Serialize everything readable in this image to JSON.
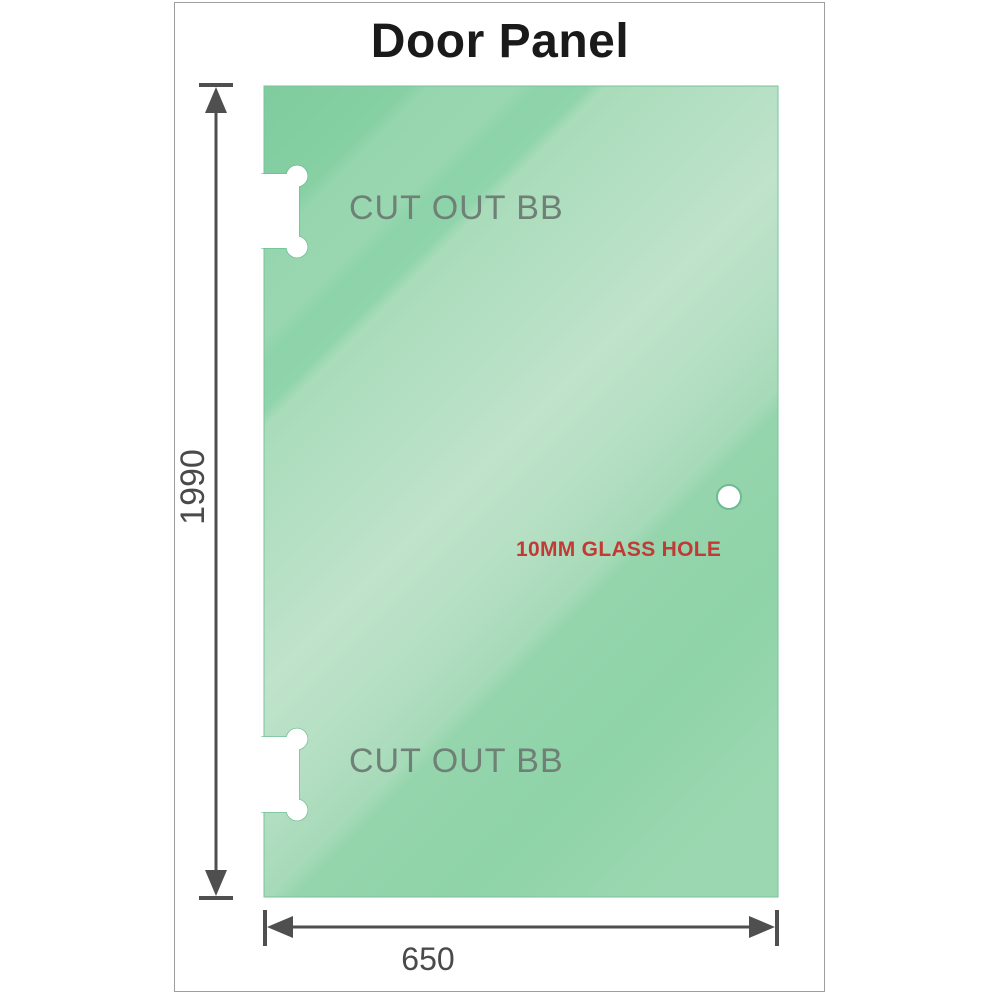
{
  "title": "Door Panel",
  "drawing": {
    "labels": {
      "cutout_top": "CUT OUT BB",
      "cutout_bottom": "CUT OUT BB",
      "glass_hole": "10MM GLASS HOLE"
    },
    "dimensions": {
      "height_mm": "1990",
      "width_mm": "650"
    },
    "colors": {
      "glass_base": "#8ed3aa",
      "glass_light_band": "#bfe3cb",
      "glass_dark_corner": "#7fcc9e",
      "cutout_label_gray": "#6f8077",
      "hole_label_red": "#c13a35",
      "dimension_gray": "#4f4f4f",
      "frame_border": "#9e9e9e",
      "title_color": "#1a1a1a"
    }
  }
}
